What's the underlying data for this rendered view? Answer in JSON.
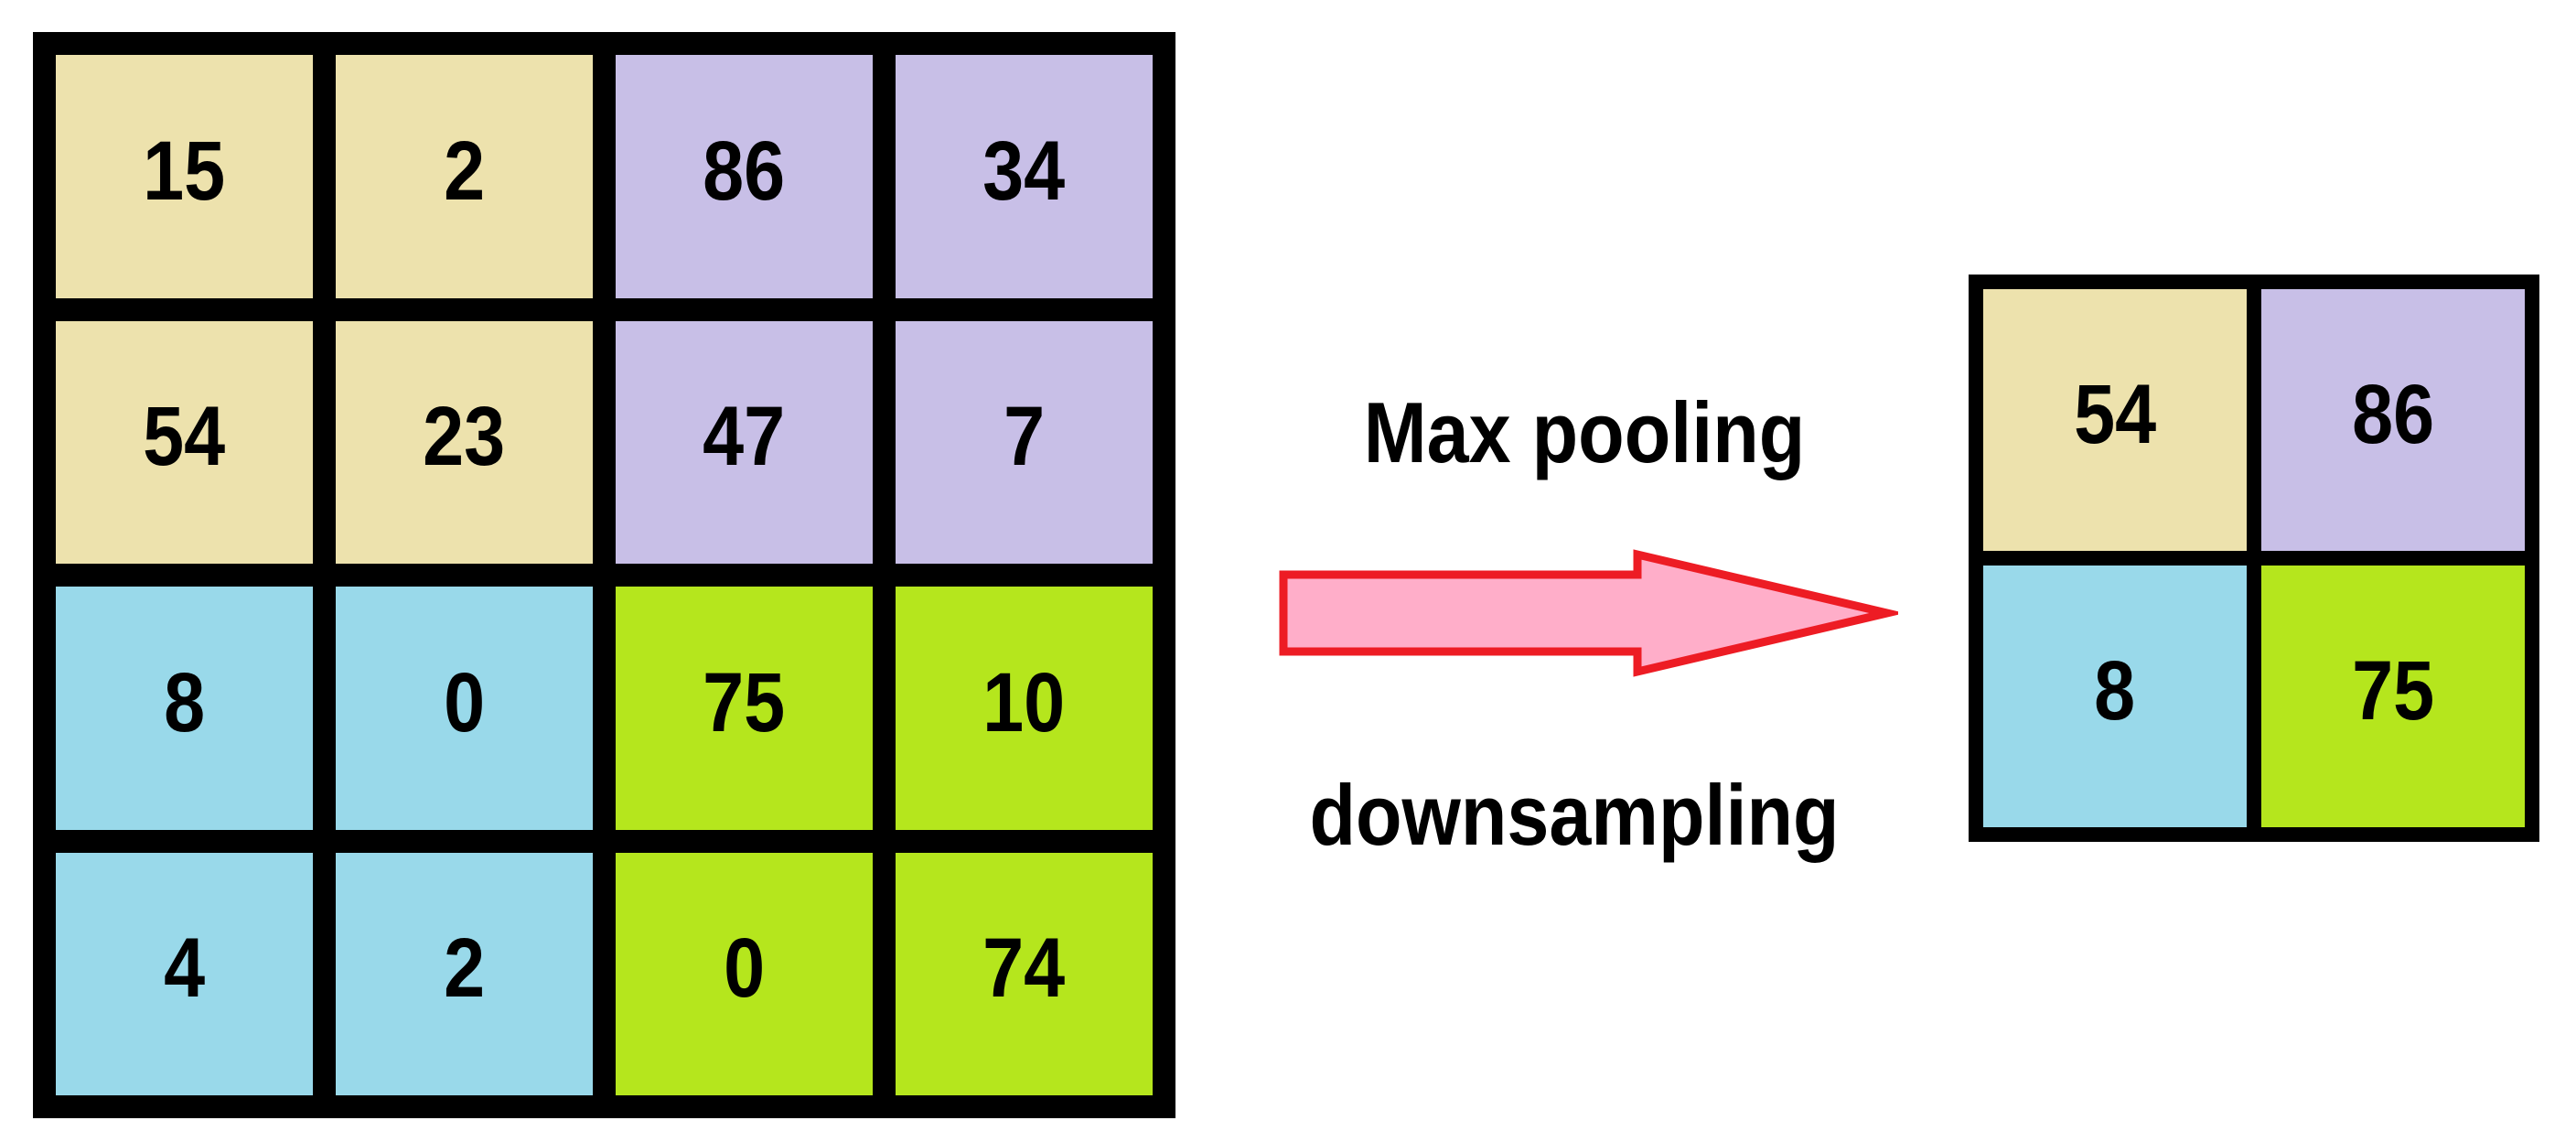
{
  "labels": {
    "process": "Max pooling",
    "method": "downsampling"
  },
  "colors": {
    "khaki": "#EDE2AD",
    "lavender": "#C8BFE7",
    "sky": "#99D9EA",
    "lime": "#B5E61D",
    "arrow_fill": "#FFAEC9",
    "arrow_stroke": "#ED1C24",
    "grid_border": "#000000",
    "background": "#FFFFFF",
    "text": "#000000"
  },
  "input_grid": {
    "name": "4x4 input feature map",
    "rows": [
      [
        {
          "value": "15",
          "color": "khaki"
        },
        {
          "value": "2",
          "color": "khaki"
        },
        {
          "value": "86",
          "color": "lavender"
        },
        {
          "value": "34",
          "color": "lavender"
        }
      ],
      [
        {
          "value": "54",
          "color": "khaki"
        },
        {
          "value": "23",
          "color": "khaki"
        },
        {
          "value": "47",
          "color": "lavender"
        },
        {
          "value": "7",
          "color": "lavender"
        }
      ],
      [
        {
          "value": "8",
          "color": "sky"
        },
        {
          "value": "0",
          "color": "sky"
        },
        {
          "value": "75",
          "color": "lime"
        },
        {
          "value": "10",
          "color": "lime"
        }
      ],
      [
        {
          "value": "4",
          "color": "sky"
        },
        {
          "value": "2",
          "color": "sky"
        },
        {
          "value": "0",
          "color": "lime"
        },
        {
          "value": "74",
          "color": "lime"
        }
      ]
    ]
  },
  "output_grid": {
    "name": "2x2 max pooled output",
    "rows": [
      [
        {
          "value": "54",
          "color": "khaki"
        },
        {
          "value": "86",
          "color": "lavender"
        }
      ],
      [
        {
          "value": "8",
          "color": "sky"
        },
        {
          "value": "75",
          "color": "lime"
        }
      ]
    ]
  }
}
